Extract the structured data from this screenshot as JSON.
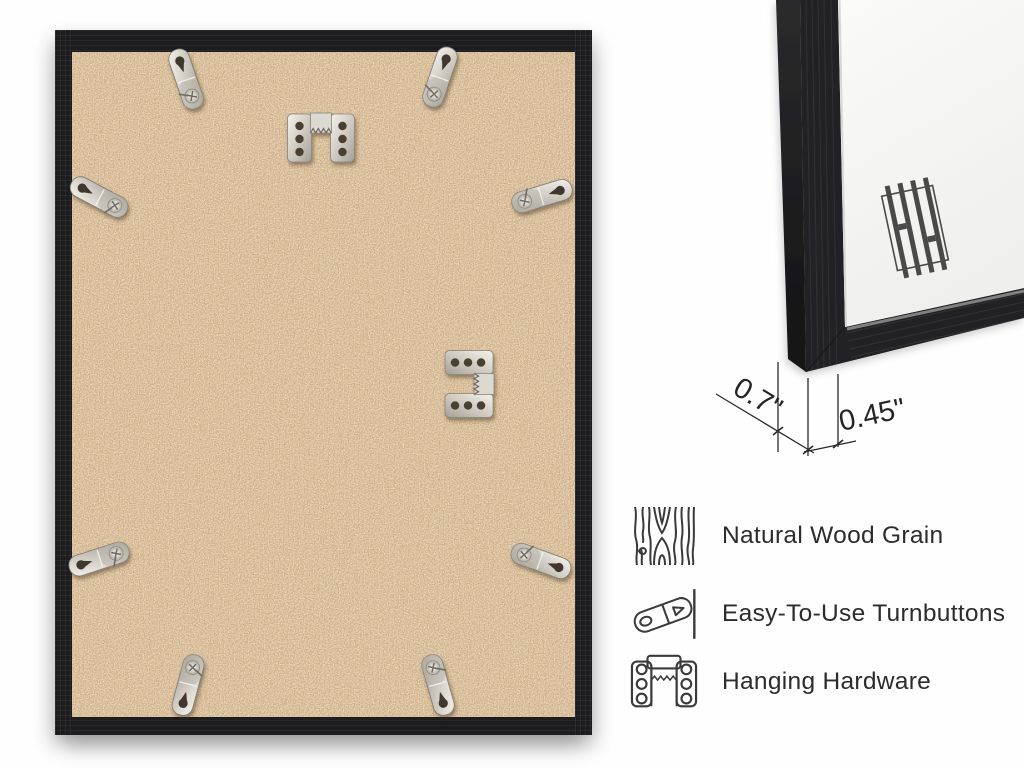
{
  "measurements": {
    "frame_depth": "0.7\"",
    "frame_face_width": "0.45\""
  },
  "features": [
    {
      "icon": "wood-grain-icon",
      "label": "Natural Wood Grain"
    },
    {
      "icon": "turnbutton-icon",
      "label": "Easy-To-Use Turnbuttons"
    },
    {
      "icon": "hanging-hardware-icon",
      "label": "Hanging Hardware"
    }
  ],
  "hardware": {
    "turnbutton_count": 8,
    "sawtooth_hanger_count": 2
  },
  "colors": {
    "frame_black": "#1e1e20",
    "backing_tan": "#ccab81",
    "metal_silver": "#d6d3cb",
    "mat_white": "#f6f6f5",
    "annotation_line": "#2b2b2b",
    "page_background": "#fefefe"
  }
}
